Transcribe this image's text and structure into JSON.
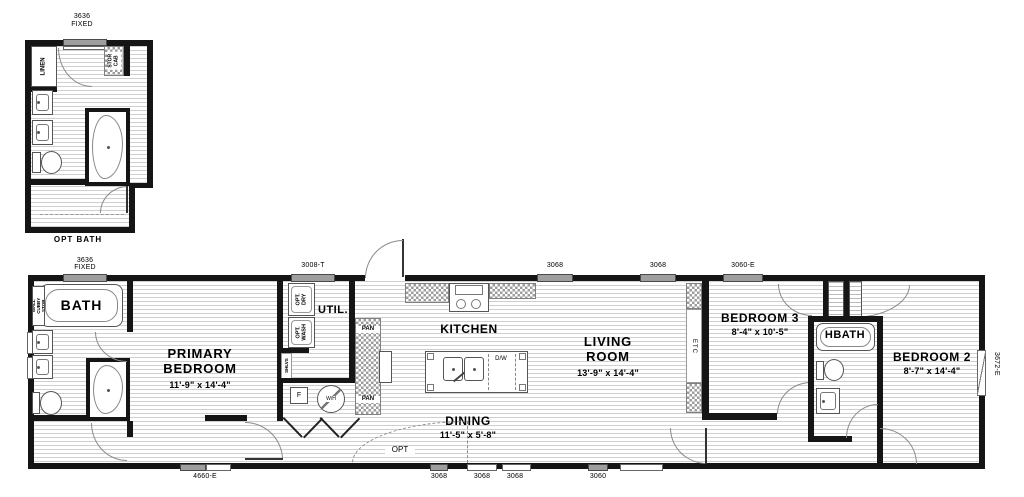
{
  "inset": {
    "window_size": "3636",
    "window_type": "FIXED",
    "linen": "LINEN",
    "stor_cab": "STOR CAB",
    "caption": "OPT BATH"
  },
  "main": {
    "windows_top": {
      "t1_size": "3636",
      "t1_type": "FIXED",
      "t2": "3008-T",
      "t3": "3068",
      "t4": "3068",
      "t5": "3060-E"
    },
    "windows_bottom": {
      "b1": "4660-E",
      "b2": "3068",
      "b3": "3068",
      "b4": "3068",
      "b5": "3060"
    },
    "door_right": "3672-E",
    "bath": {
      "name": "BATH",
      "cubby": "WALL CUBBY STOR"
    },
    "primary": {
      "line1": "PRIMARY",
      "line2": "BEDROOM",
      "dims": "11'-9\" x 14'-4\""
    },
    "util": {
      "name": "UTIL.",
      "dry": "OPT. DRY",
      "wash": "OPT. WASH",
      "shelves": "SHLVS",
      "furnace": "F",
      "water_heater": "W/H"
    },
    "kitchen": {
      "name": "KITCHEN",
      "dw": "D/W",
      "pan": "PAN"
    },
    "living": {
      "line1": "LIVING",
      "line2": "ROOM",
      "dims": "13'-9\" x 14'-4\"",
      "etc": "ETC"
    },
    "dining": {
      "name": "DINING",
      "dims": "11'-5\" x 5'-8\"",
      "opt": "OPT"
    },
    "bedroom3": {
      "name": "BEDROOM 3",
      "dims": "8'-4\" x 10'-5\""
    },
    "hbath": {
      "name": "HBATH"
    },
    "bedroom2": {
      "name": "BEDROOM 2",
      "dims": "8'-7\" x 14'-4\""
    }
  }
}
